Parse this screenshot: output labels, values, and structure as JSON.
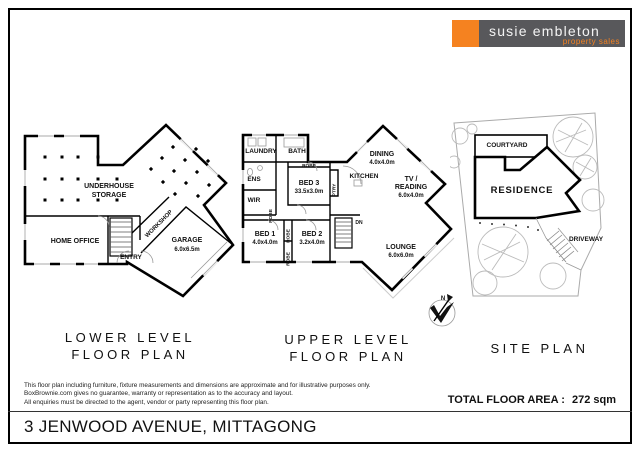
{
  "logo": {
    "brand": "susie embleton",
    "tagline": "property sales",
    "accent_color": "#F58220",
    "bar_color": "#58585b"
  },
  "plans": {
    "lower": {
      "title1": "LOWER LEVEL",
      "title2": "FLOOR PLAN",
      "rooms": {
        "storage1": "UNDERHOUSE",
        "storage2": "STORAGE",
        "home_office": "HOME OFFICE",
        "entry": "ENTRY",
        "workshop": "WORKSHOP",
        "garage": "GARAGE",
        "garage_dim": "6.0x6.5m"
      }
    },
    "upper": {
      "title1": "UPPER LEVEL",
      "title2": "FLOOR PLAN",
      "rooms": {
        "laundry": "LAUNDRY",
        "bath": "BATH",
        "ens": "ENS",
        "wir": "WIR",
        "robe": "ROBE",
        "bed3": "BED 3",
        "bed3_dim": "33.5x3.0m",
        "ptry": "PTRY",
        "kitchen": "KITCHEN",
        "dining": "DINING",
        "dining_dim": "4.0x4.0m",
        "tv1": "TV /",
        "tv2": "READING",
        "tv_dim": "6.0x4.0m",
        "bed1": "BED 1",
        "bed1_dim": "4.0x4.0m",
        "bed2": "BED 2",
        "bed2_dim": "3.2x4.0m",
        "lounge": "LOUNGE",
        "lounge_dim": "6.0x6.0m",
        "dn": "DN"
      }
    },
    "site": {
      "title": "SITE PLAN",
      "labels": {
        "courtyard": "COURTYARD",
        "residence": "RESIDENCE",
        "driveway": "DRIVEWAY"
      },
      "north": "N"
    }
  },
  "footer": {
    "disclaimer1": "This floor plan including furniture, fixture measurements and dimensions are approximate and for illustrative purposes only.",
    "disclaimer2": "BoxBrownie.com gives no guarantee, warranty or representation as to the accuracy and layout.",
    "disclaimer3": "All enquiries must be directed to the agent, vendor or party representing this floor plan.",
    "total_label": "TOTAL FLOOR AREA :",
    "total_value": "272 sqm",
    "address": "3 JENWOOD AVENUE, MITTAGONG"
  }
}
